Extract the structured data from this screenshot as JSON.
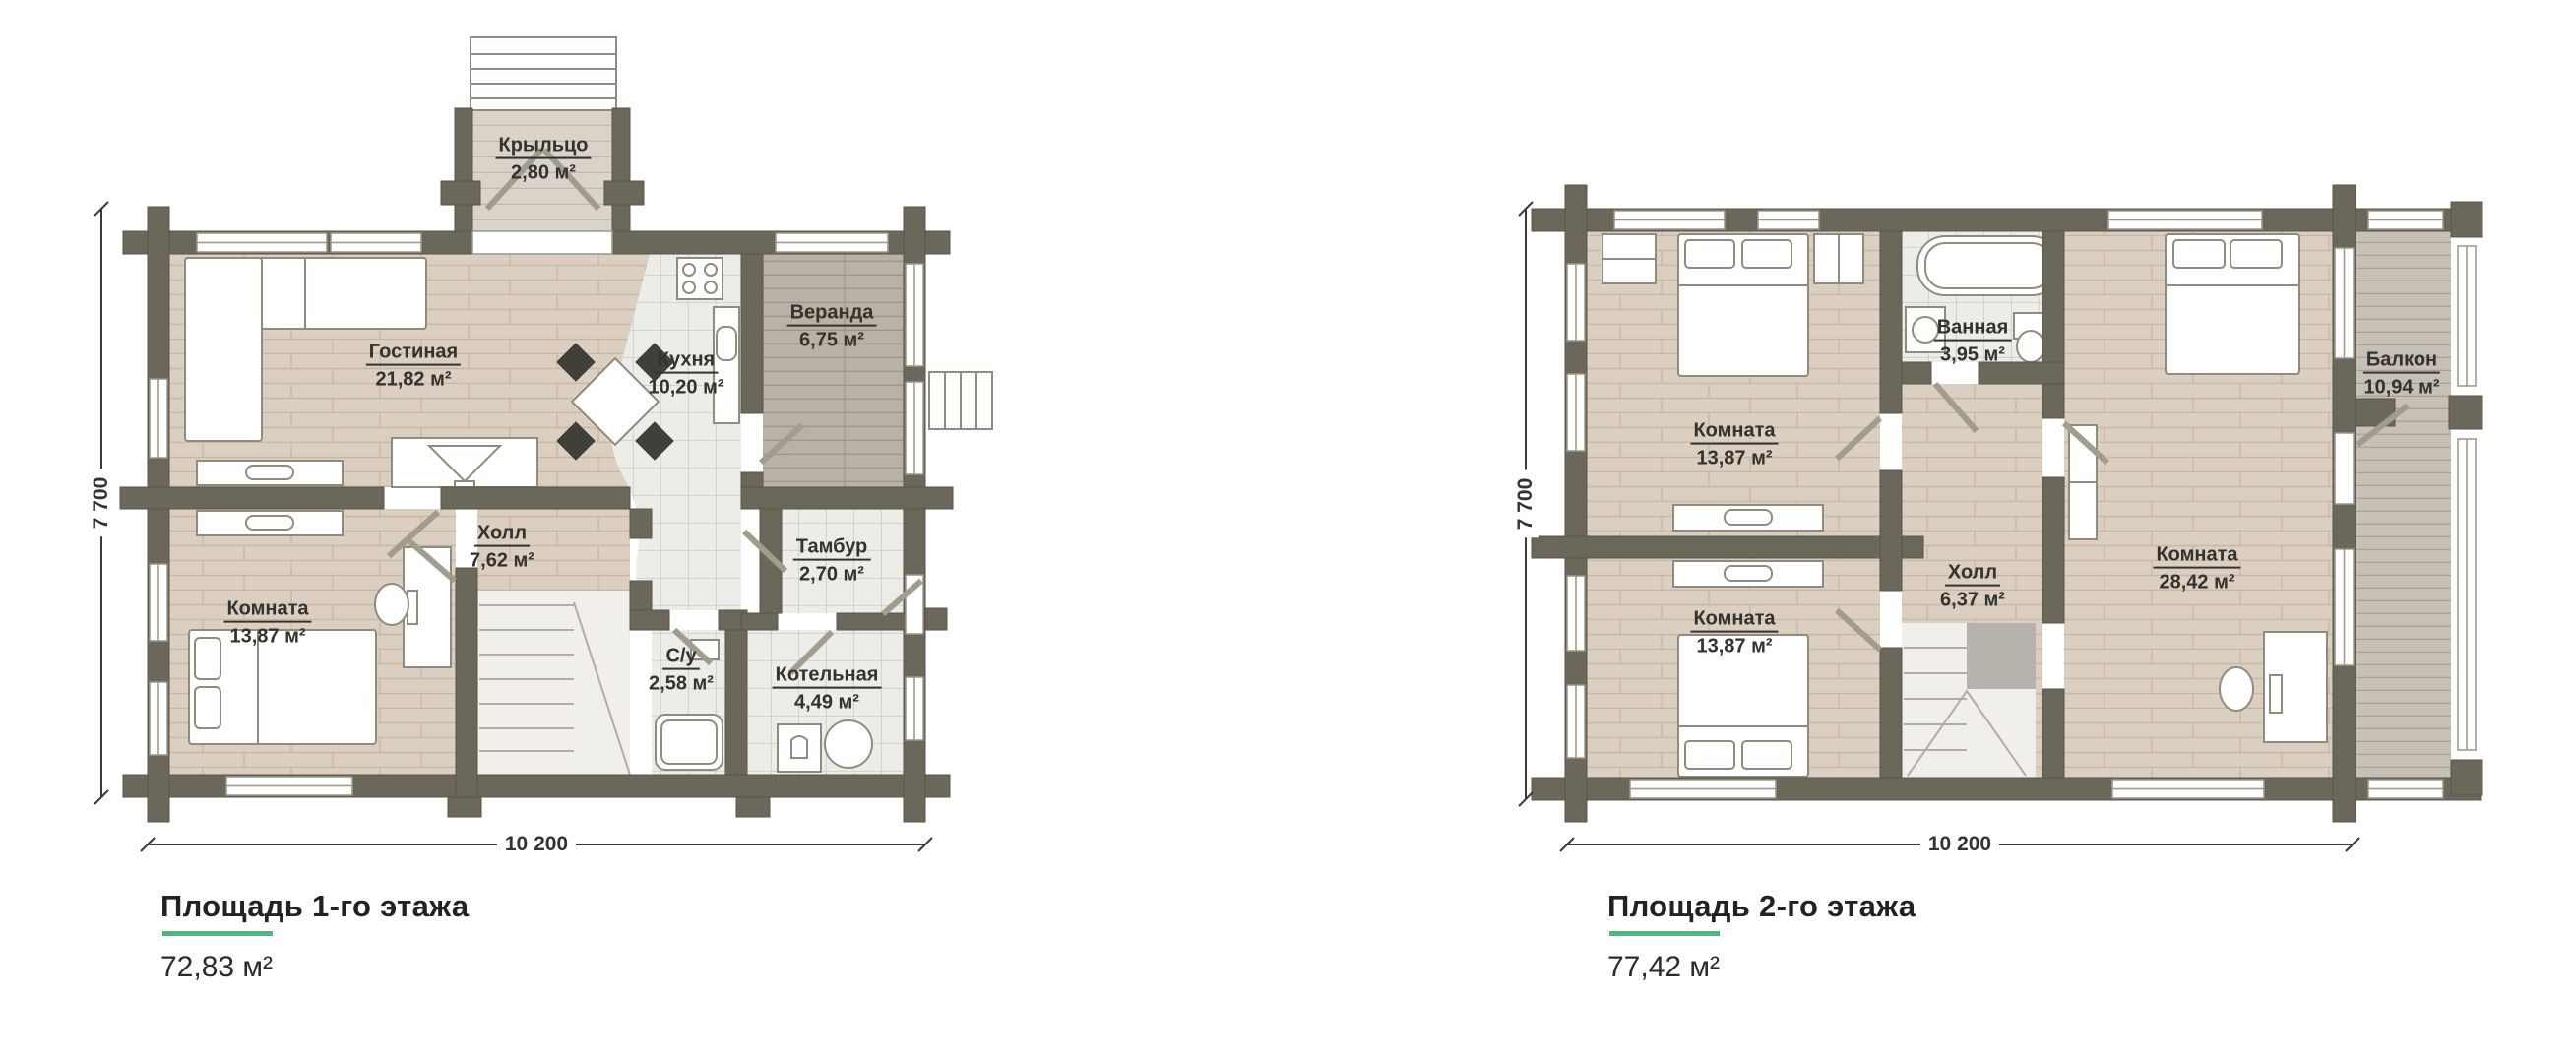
{
  "colors": {
    "accent_green": "#53b483",
    "wall": "#6b675a",
    "wood_floor": "#dbcfc2",
    "tile_floor": "#ecece9",
    "veranda_floor": "#b9b1a6",
    "balcony_floor": "#c6c0b6"
  },
  "floor1": {
    "title": "Площадь 1-го этажа",
    "area_value": "72,83 м²",
    "dim_bottom": "10 200",
    "dim_left": "7 700",
    "rooms": [
      {
        "name": "Крыльцо",
        "area": "2,80 м²"
      },
      {
        "name": "Гостиная",
        "area": "21,82 м²"
      },
      {
        "name": "Кухня",
        "area": "10,20 м²"
      },
      {
        "name": "Веранда",
        "area": "6,75 м²"
      },
      {
        "name": "Холл",
        "area": "7,62 м²"
      },
      {
        "name": "Тамбур",
        "area": "2,70 м²"
      },
      {
        "name": "Комната",
        "area": "13,87 м²"
      },
      {
        "name": "С/у",
        "area": "2,58 м²"
      },
      {
        "name": "Котельная",
        "area": "4,49 м²"
      }
    ]
  },
  "floor2": {
    "title": "Площадь 2-го этажа",
    "area_value": "77,42 м²",
    "dim_bottom": "10 200",
    "dim_left": "7 700",
    "rooms": [
      {
        "name": "Комната",
        "area": "13,87 м²"
      },
      {
        "name": "Ванная",
        "area": "3,95 м²"
      },
      {
        "name": "Комната",
        "area": "13,87 м²"
      },
      {
        "name": "Холл",
        "area": "6,37 м²"
      },
      {
        "name": "Комната",
        "area": "28,42 м²"
      },
      {
        "name": "Балкон",
        "area": "10,94 м²"
      }
    ]
  }
}
